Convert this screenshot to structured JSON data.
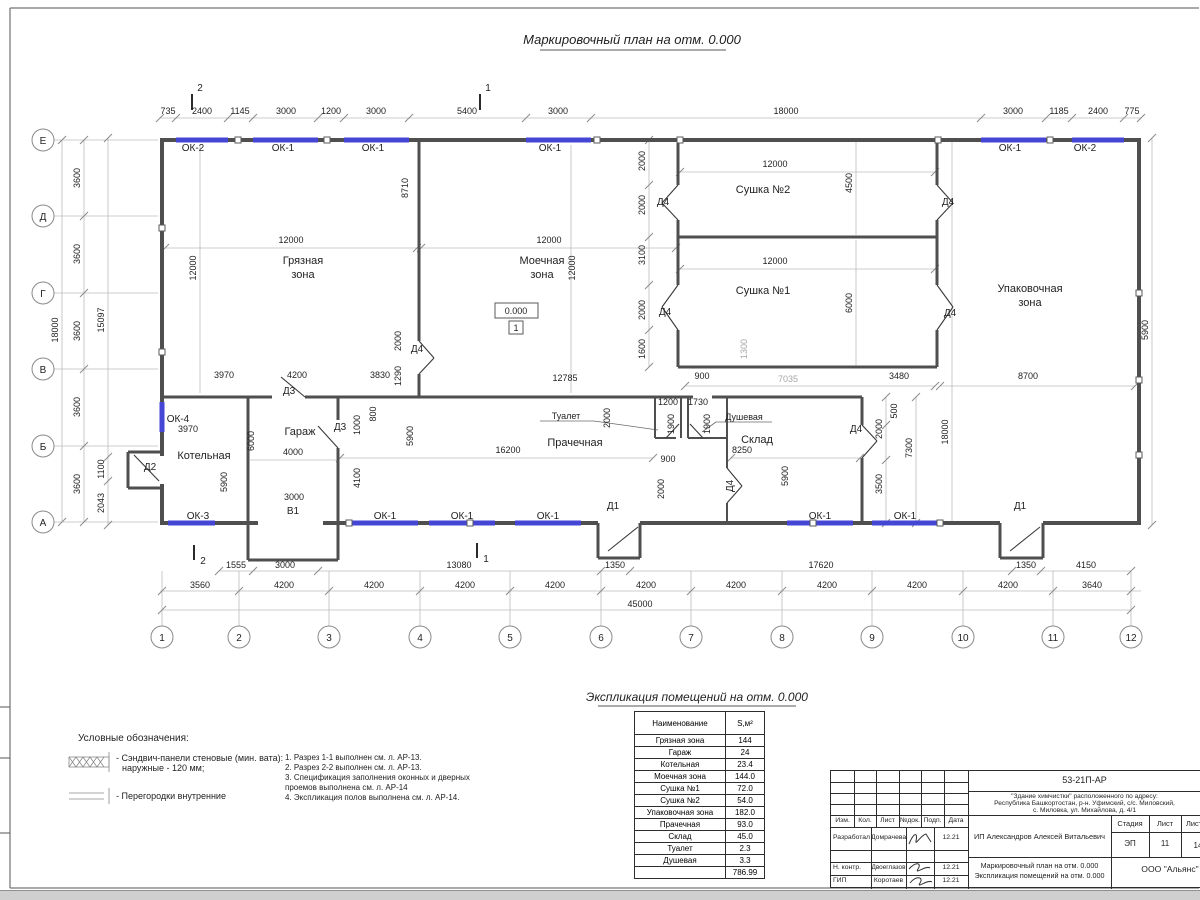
{
  "page": {
    "title": "Маркировочный план на отм. 0.000",
    "table_title": "Экспликация помещений на отм. 0.000"
  },
  "axis": {
    "rows": [
      "Е",
      "Д",
      "Г",
      "В",
      "Б",
      "А"
    ],
    "cols": [
      "1",
      "2",
      "3",
      "4",
      "5",
      "6",
      "7",
      "8",
      "9",
      "10",
      "11",
      "12"
    ]
  },
  "dims": {
    "top": [
      "735",
      "2400",
      "1145",
      "3000",
      "1200",
      "3000",
      "5400",
      "3000",
      "18000",
      "3000",
      "1185",
      "2400",
      "775"
    ],
    "b1": [
      "1555",
      "3000",
      "13080",
      "1350",
      "17620",
      "1350",
      "4150"
    ],
    "b2": [
      "3560",
      "4200",
      "4200",
      "4200",
      "4200",
      "4200",
      "4200",
      "4200",
      "4200",
      "4200",
      "3640"
    ],
    "btotal": "45000",
    "ltotal": "18000",
    "l36": [
      "3600",
      "3600",
      "3600",
      "3600",
      "3600"
    ],
    "linner": [
      "15097",
      "1100",
      "2043"
    ]
  },
  "pd": [
    "12000",
    "12000",
    "12000",
    "12000",
    "8710",
    "12000",
    "4500",
    "2000",
    "2000",
    "12000",
    "6000",
    "3100",
    "2000",
    "1600",
    "1300",
    "7035",
    "900",
    "3480",
    "8700",
    "18000",
    "7300",
    "500",
    "2000",
    "3500",
    "3970",
    "4200",
    "3830",
    "12785",
    "2000",
    "1290",
    "3970",
    "5900",
    "6000",
    "4000",
    "1000",
    "800",
    "4100",
    "5900",
    "3000",
    "16200",
    "2000",
    "1200",
    "1730",
    "1900",
    "1900",
    "900",
    "2000",
    "8250",
    "5900",
    "18240"
  ],
  "windows": {
    "top": [
      "ОК-2",
      "ОК-1",
      "ОК-1",
      "ОК-1",
      "ОК-1",
      "ОК-2"
    ],
    "bottom": [
      "ОК-3",
      "ОК-1",
      "ОК-1",
      "ОК-1",
      "ОК-1",
      "ОК-1"
    ],
    "left": "ОК-4"
  },
  "doors": {
    "d1": "Д1",
    "d2": "Д2",
    "d3": "Д3",
    "d4": "Д4",
    "v1": "В1"
  },
  "rooms": {
    "dirty": [
      "Грязная",
      "зона"
    ],
    "wash": [
      "Моечная",
      "зона"
    ],
    "dry2": "Сушка №2",
    "dry1": "Сушка №1",
    "pack": [
      "Упаковочная",
      "зона"
    ],
    "boiler": "Котельная",
    "garage": "Гараж",
    "laundry": "Прачечная",
    "storage": "Склад",
    "toilet": "Туалет",
    "shower": "Душевая"
  },
  "elevation": {
    "value": "0.000",
    "flag": "1"
  },
  "sections": {
    "one": "1",
    "two": "2"
  },
  "legend": {
    "title": "Условные обозначения:",
    "item1a": "- Сэндвич-панели стеновые (мин. вата):",
    "item1b": "наружные - 120 мм;",
    "item2": "- Перегородки внутренние"
  },
  "notes": [
    "1. Разрез 1-1 выполнен см. л. АР-13.",
    "2. Разрез 2-2 выполнен см. л. АР-13.",
    "3. Спецификация заполнения оконных и дверных",
    "проемов выполнена см. л. АР-14",
    "4. Экспликация полов выполнена см. л. АР-14."
  ],
  "table": {
    "col1": "Наименование",
    "col2": "S,м²",
    "rows": [
      [
        "Грязная зона",
        "144"
      ],
      [
        "Гараж",
        "24"
      ],
      [
        "Котельная",
        "23.4"
      ],
      [
        "Моечная зона",
        "144.0"
      ],
      [
        "Сушка №1",
        "72.0"
      ],
      [
        "Сушка №2",
        "54.0"
      ],
      [
        "Упаковочная зона",
        "182.0"
      ],
      [
        "Прачечная",
        "93.0"
      ],
      [
        "Склад",
        "45.0"
      ],
      [
        "Туалет",
        "2.3"
      ],
      [
        "Душевая",
        "3.3"
      ]
    ],
    "total": "786.99"
  },
  "tb": {
    "code": "53-21П-АР",
    "addr1": "\"Здание химчистки\" расположенного по адресу:",
    "addr2": "Республика Башкортостан, р-н. Уфимский, с/с. Миловский,",
    "addr3": "с. Миловка, ул. Михайлова, д. 4/1",
    "h": [
      "Изм.",
      "Кол.",
      "Лист",
      "№док.",
      "Подп.",
      "Дата"
    ],
    "r1role": "Разработал",
    "r1name": "Домрачева",
    "r2role": "Н. контр.",
    "r2name": "Двоеглазов",
    "r3role": "ГИП",
    "r3name": "Коротаев",
    "date": "12.21",
    "client": "ИП Александров Алексей Витальевич",
    "stadia_h": "Стадия",
    "list_h": "Лист",
    "listov_h": "Листов",
    "stadia": "ЭП",
    "list": "11",
    "listov": "14",
    "doc1": "Маркировочный план на отм. 0.000",
    "doc2": "Экспликация помещений на отм. 0.000",
    "org": "ООО \"Альянс\""
  },
  "colors": {
    "window": "#4646d6",
    "wall": "#4f4f4f",
    "dimline": "#bcbcbc"
  }
}
